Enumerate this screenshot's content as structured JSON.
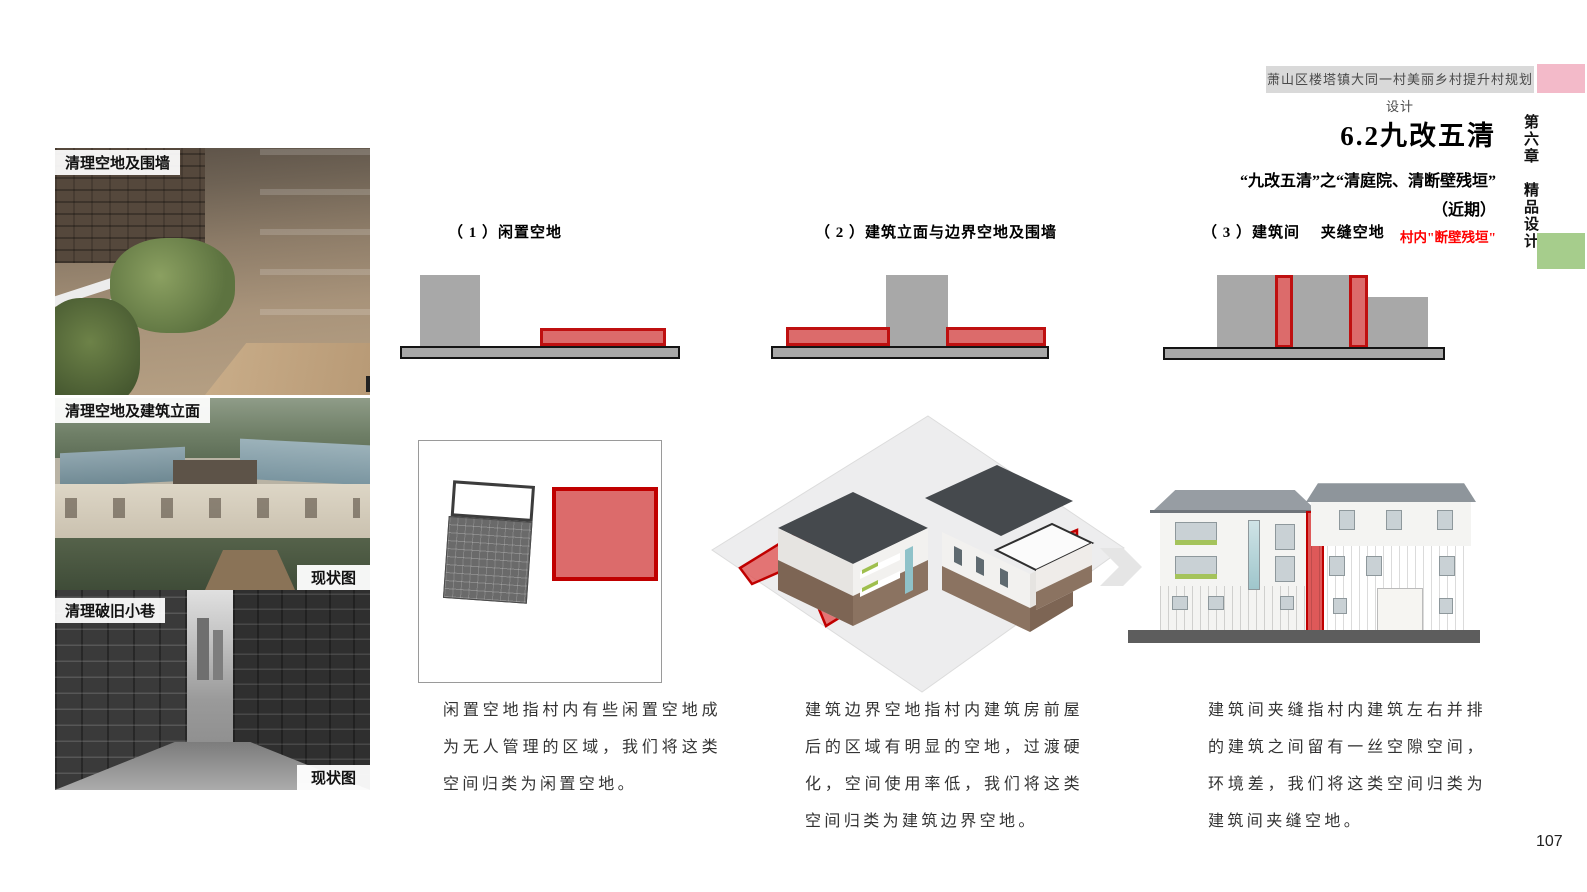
{
  "header": {
    "title": "萧山区楼塔镇大同一村美丽乡村提升村规划设计"
  },
  "sidebar": {
    "chapter": "第六章　精品设计"
  },
  "section": {
    "title": "6.2九改五清",
    "subtitle": "“九改五清”之“清庭院、清断壁残垣”",
    "term": "（近期）",
    "highlight": "村内\"断壁残垣\""
  },
  "photos": [
    {
      "label": "清理空地及围墙"
    },
    {
      "label": "清理空地及建筑立面",
      "caption": "现状图"
    },
    {
      "label": "清理破旧小巷",
      "caption": "现状图"
    }
  ],
  "columns": [
    {
      "heading": "（ 1 ）闲置空地",
      "description": "闲置空地指村内有些闲置空地成为无人管理的区域，我们将这类空间归类为闲置空地。"
    },
    {
      "heading": "（ 2 ）建筑立面与边界空地及围墙",
      "description": "建筑边界空地指村内建筑房前屋后的区域有明显的空地，过渡硬化，空间使用率低，我们将这类空间归类为建筑边界空地。"
    },
    {
      "heading": "（ 3 ）建筑间　 夹缝空地",
      "description": "建筑间夹缝指村内建筑左右并排的建筑之间留有一丝空隙空间，环境差，我们将这类空间归类为建筑间夹缝空地。"
    }
  ],
  "page": {
    "number": "107"
  },
  "colors": {
    "accent_red_border": "#c00000",
    "accent_red_fill": "#dc6b6b",
    "diagram_gray": "#a8a8a8",
    "pink_tab": "#f3bac9",
    "green_tab": "#a6cd8c",
    "highlight_text_red": "#ff0000"
  }
}
